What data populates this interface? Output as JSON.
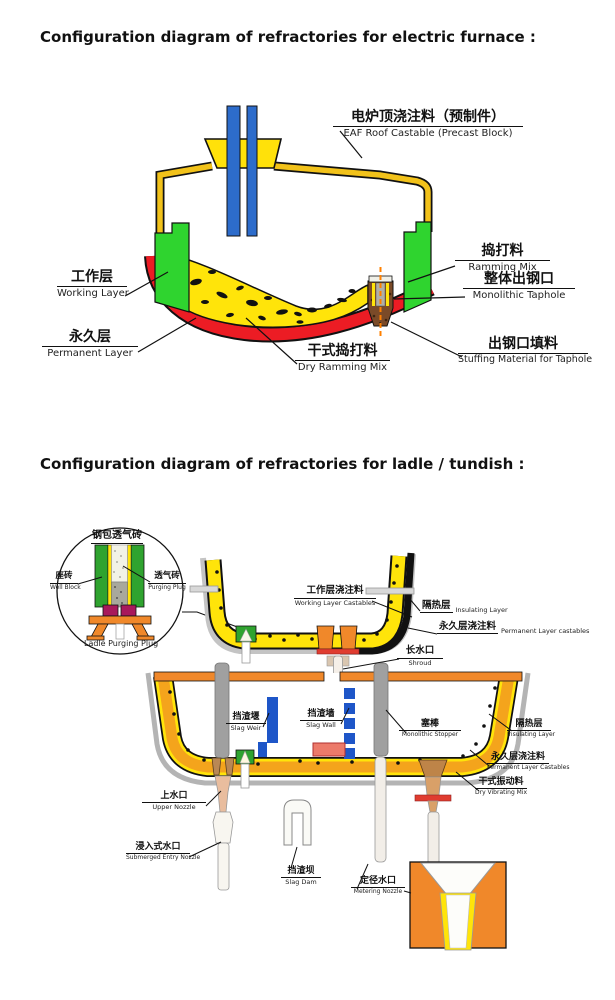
{
  "title_furnace": "Configuration diagram of refractories for electric furnace :",
  "title_ladle": "Configuration diagram of refractories for ladle / tundish :",
  "furnace": {
    "roof": {
      "zh": "电炉顶浇注料（预制件）",
      "en": "EAF Roof Castable (Precast Block)"
    },
    "working_layer": {
      "zh": "工作层",
      "en": "Working Layer"
    },
    "permanent_layer": {
      "zh": "永久层",
      "en": "Permanent Layer"
    },
    "dry_ramming": {
      "zh": "干式捣打料",
      "en": "Dry Ramming Mix"
    },
    "ramming_mix": {
      "zh": "捣打料",
      "en": "Ramming Mix"
    },
    "monolithic_taphole": {
      "zh": "整体出钢口",
      "en": "Monolithic Taphole"
    },
    "stuffing": {
      "zh": "出钢口填料",
      "en": "Stuffing Material for Taphole"
    }
  },
  "inset_circle": {
    "title": {
      "zh": "钢包透气砖"
    },
    "well_block": {
      "zh": "座砖",
      "en": "Well Block"
    },
    "purging_plug": {
      "zh": "透气砖",
      "en": "Purging Plug"
    },
    "caption": {
      "en": "Ladle Purging Plug"
    }
  },
  "ladle": {
    "working_castables": {
      "zh": "工作层浇注料",
      "en": "Working Layer Castables"
    },
    "insulating": {
      "zh": "隔热层",
      "en": "Insulating Layer"
    },
    "permanent_castables": {
      "zh": "永久层浇注料",
      "en": "Permanent Layer castables"
    },
    "shroud": {
      "zh": "长水口",
      "en": "Shroud"
    }
  },
  "tundish": {
    "slag_weir": {
      "zh": "挡渣堰",
      "en": "Slag Weir"
    },
    "slag_wall": {
      "zh": "挡渣墙",
      "en": "Slag Wall"
    },
    "stopper": {
      "zh": "塞棒",
      "en": "Monolithic Stopper"
    },
    "upper_nozzle": {
      "zh": "上水口",
      "en": "Upper Nozzle"
    },
    "sen": {
      "zh": "浸入式水口",
      "en": "Submerged Entry Nozzle"
    },
    "slag_dam": {
      "zh": "挡渣坝",
      "en": "Slag Dam"
    },
    "metering_nozzle": {
      "zh": "定径水口",
      "en": "Metering Nozzle"
    },
    "insulating": {
      "zh": "隔热层",
      "en": "Insulating Layer"
    },
    "permanent_castables": {
      "zh": "永久层浇注料",
      "en": "Permanent Layer Castables"
    },
    "dry_vibrating": {
      "zh": "干式振动料",
      "en": "Dry Vibrating Mix"
    }
  },
  "colors": {
    "yellow_lining": "#FFE40A",
    "gold_shell": "#F2C21A",
    "red_permanent": "#EC1C24",
    "green_working": "#2FD42F",
    "electrode_blue": "#2D6CCB",
    "slag_blue": "#1E56C8",
    "orange_rim": "#F0882A",
    "tundish_lining_orange": "#F4A41C",
    "taphole_brown": "#7A4A28",
    "plug_magenta": "#A8195C",
    "impact_pad_pink": "#EC7A6A"
  }
}
